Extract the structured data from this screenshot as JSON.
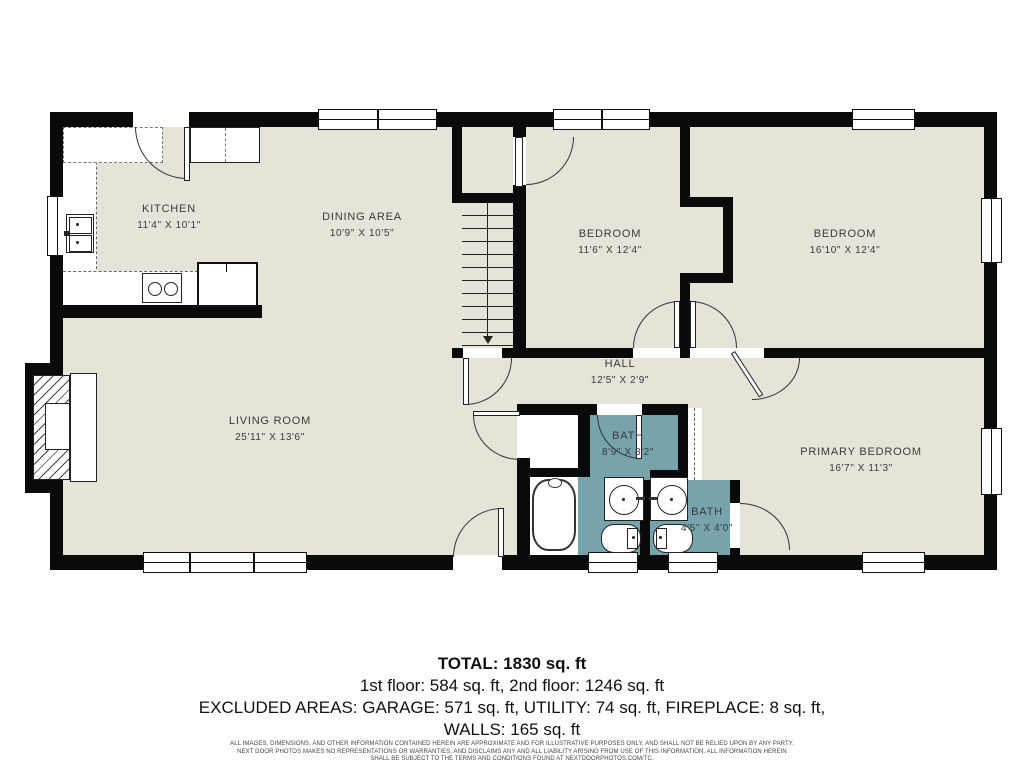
{
  "plan": {
    "colors": {
      "floor": "#e6e4d8",
      "bath": "#76a3ac",
      "wall": "#0a0a0a",
      "label": "#3a3a3a"
    },
    "rooms": [
      {
        "name": "KITCHEN",
        "dims": "11'4\" X 10'1\""
      },
      {
        "name": "DINING AREA",
        "dims": "10'9\" X 10'5\""
      },
      {
        "name": "BEDROOM",
        "dims": "11'6\" X 12'4\""
      },
      {
        "name": "BEDROOM",
        "dims": "16'10\" X 12'4\""
      },
      {
        "name": "HALL",
        "dims": "12'5\" X 2'9\""
      },
      {
        "name": "LIVING ROOM",
        "dims": "25'11\" X 13'6\""
      },
      {
        "name": "BATH",
        "dims": "8'9\" X 8'2\""
      },
      {
        "name": "BATH",
        "dims": "4'5\" X 4'0\""
      },
      {
        "name": "PRIMARY BEDROOM",
        "dims": "16'7\" X 11'3\""
      }
    ]
  },
  "summary": {
    "total": "TOTAL: 1830 sq. ft",
    "floors": "1st floor: 584 sq. ft, 2nd floor: 1246 sq. ft",
    "excluded": "EXCLUDED AREAS: GARAGE: 571 sq. ft, UTILITY: 74 sq. ft, FIREPLACE: 8 sq. ft,",
    "walls": "WALLS: 165 sq. ft"
  },
  "disclaimer": {
    "line1": "ALL IMAGES, DIMENSIONS, AND OTHER INFORMATION CONTAINED HEREIN ARE APPROXIMATE AND FOR ILLUSTRATIVE PURPOSES ONLY, AND SHALL NOT BE RELIED UPON BY ANY PARTY.",
    "line2": "NEXT DOOR PHOTOS MAKES NO REPRESENTATIONS OR WARRANTIES, AND DISCLAIMS ANY AND ALL LIABILITY ARISING FROM USE OF THIS INFORMATION. ALL INFORMATION HEREIN",
    "line3": "SHALL BE SUBJECT TO THE TERMS AND CONDITIONS FOUND AT NEXTDOORPHOTOS.COM/TC."
  }
}
